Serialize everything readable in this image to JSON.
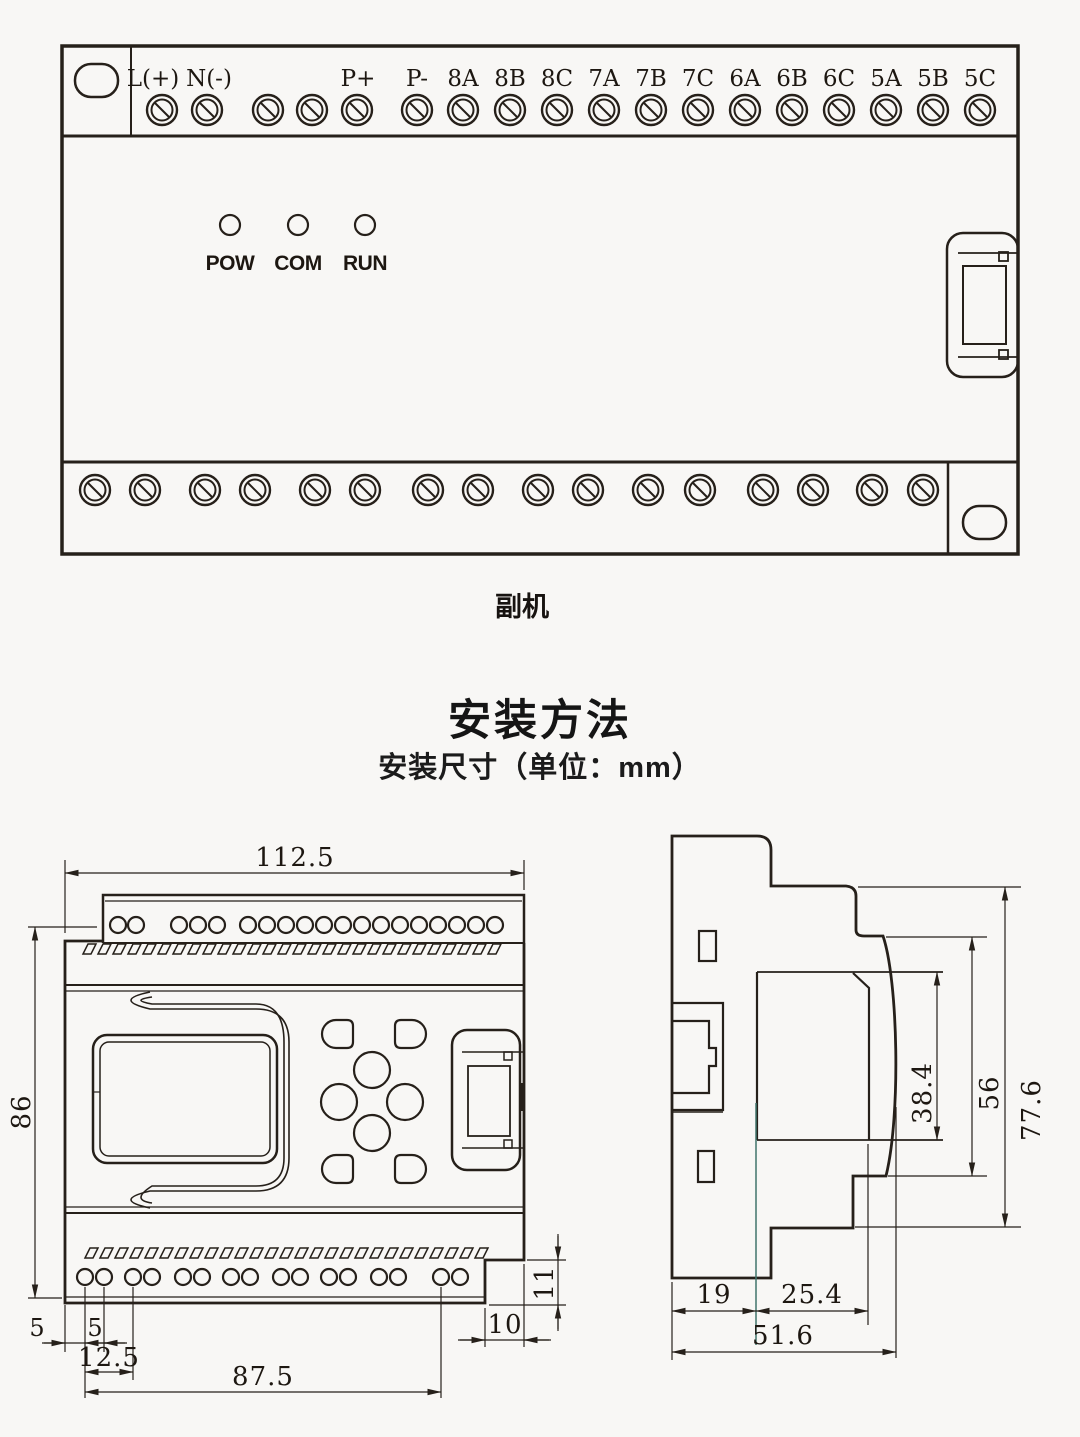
{
  "device": {
    "caption": "副机",
    "top_terminals": [
      "L(+)",
      "N(-)",
      "P+",
      "P-",
      "8A",
      "8B",
      "8C",
      "7A",
      "7B",
      "7C",
      "6A",
      "6B",
      "6C",
      "5A",
      "5B",
      "5C"
    ],
    "leds": [
      "POW",
      "COM",
      "RUN"
    ]
  },
  "install": {
    "title": "安装方法",
    "subtitle": "安装尺寸（单位：mm）"
  },
  "front_dims": {
    "width": "112.5",
    "height": "86",
    "left_gap": "5",
    "hole_gap": "5",
    "first_pitch": "12.5",
    "hole_span": "87.5",
    "notch_width": "10",
    "notch_height": "11"
  },
  "side_dims": {
    "clip_depth": "19",
    "recess_depth": "25.4",
    "total_depth": "51.6",
    "recess_height": "38.4",
    "face_height": "56",
    "total_height": "77.6"
  },
  "colors": {
    "line": "#26201a",
    "teal_ext": "#41756d",
    "background": "#f8f7f5"
  }
}
